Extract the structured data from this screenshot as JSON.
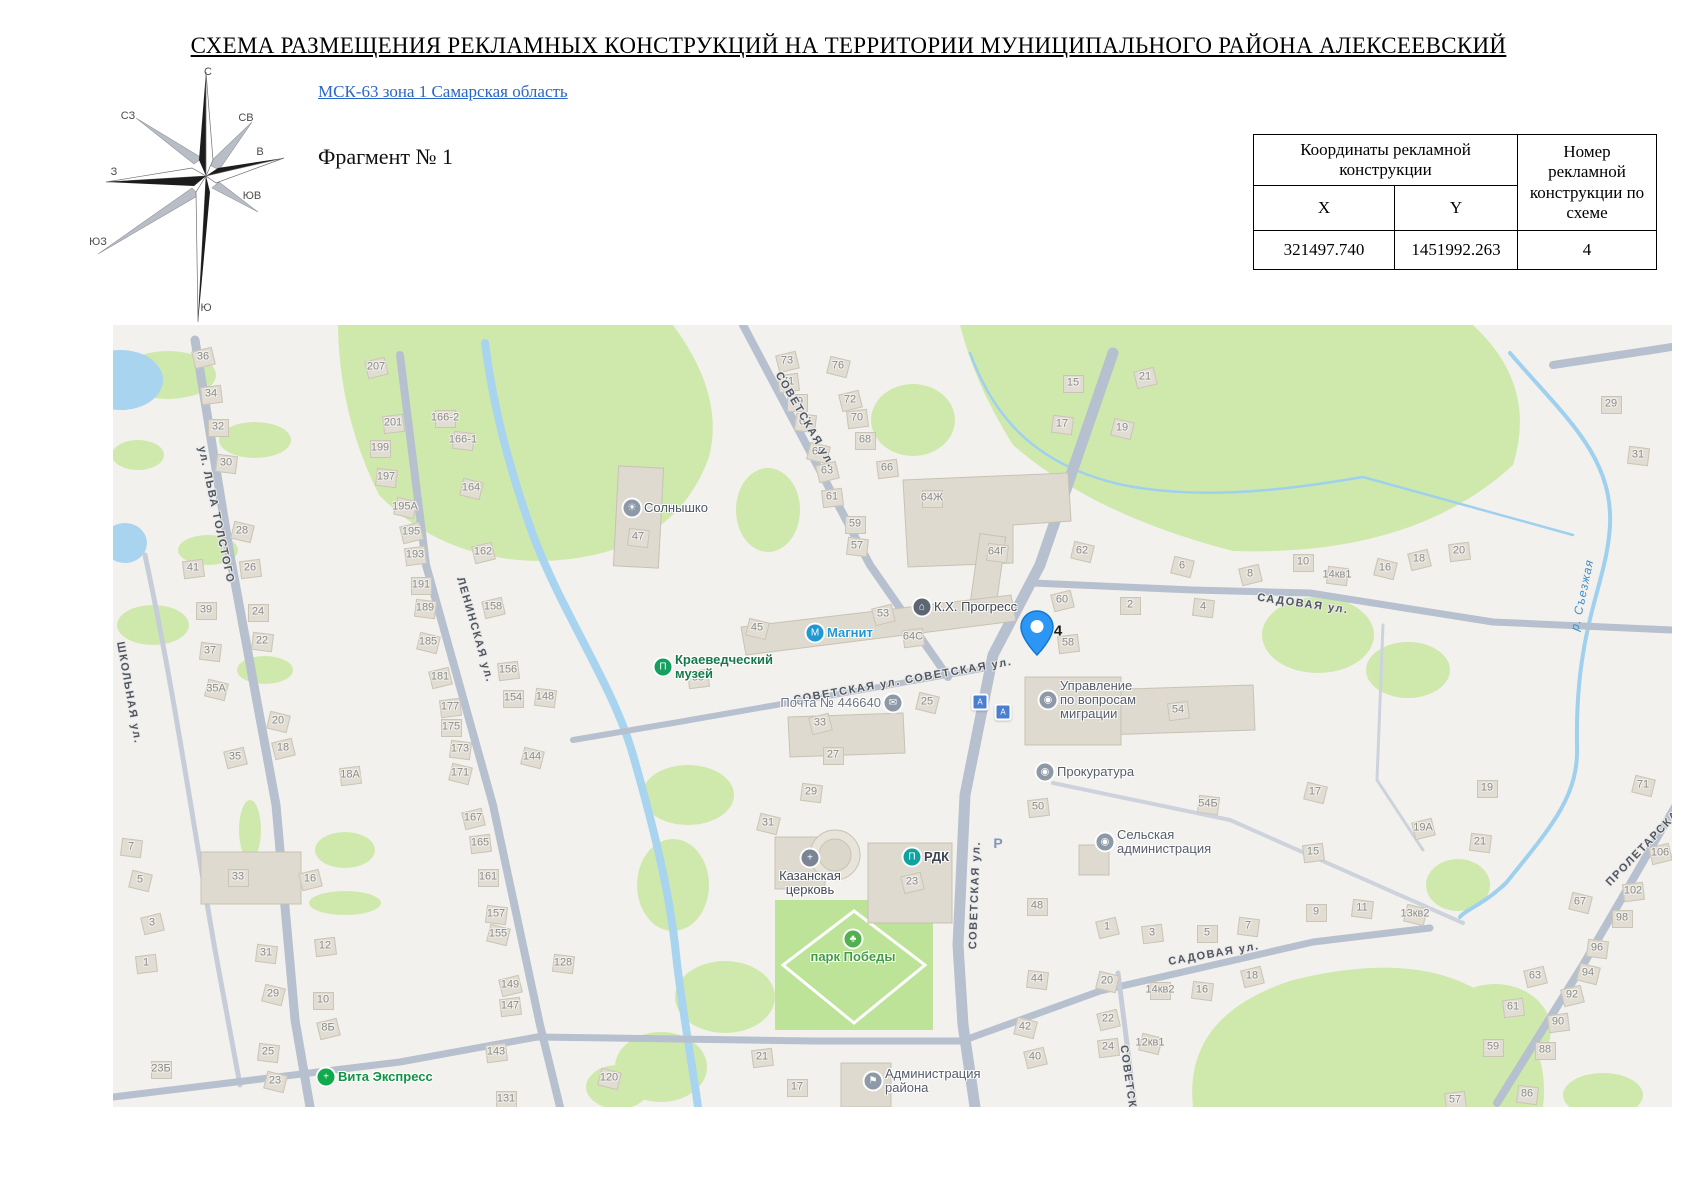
{
  "title": "СХЕМА РАЗМЕЩЕНИЯ РЕКЛАМНЫХ КОНСТРУКЦИЙ НА ТЕРРИТОРИИ МУНИЦИПАЛЬНОГО РАЙОНА АЛЕКСЕЕВСКИЙ",
  "header": {
    "link_label": "МСК-63 зона 1 Самарская область",
    "fragment_label": "Фрагмент № 1"
  },
  "compass": {
    "n": "С",
    "ne": "СВ",
    "e": "В",
    "se": "ЮВ",
    "s": "Ю",
    "sw": "ЮЗ",
    "w": "З",
    "nw": "СЗ"
  },
  "table": {
    "coords_header": "Координаты рекламной конструкции",
    "x_header": "X",
    "y_header": "Y",
    "number_header": "Номер рекламной конструкции по схеме",
    "x_value": "321497.740",
    "y_value": "1451992.263",
    "number_value": "4"
  },
  "map": {
    "colors": {
      "road": "#b6c0cf",
      "green": "#cfe9ad",
      "water": "#a8d4f0",
      "pin_blue": "#2b96f3",
      "building": "#dedacf"
    },
    "placemark": {
      "number": "4",
      "x": 924,
      "y": 330,
      "label_x": 945,
      "label_y": 306
    },
    "street_labels": [
      [
        "ул. ЛЬВА ТОЛСТОГО",
        103,
        190,
        78
      ],
      [
        "ШКОЛЬНАЯ ул.",
        16,
        368,
        80
      ],
      [
        "ЛЕНИНСКАЯ ул.",
        362,
        305,
        74
      ],
      [
        "СОВЕТСКАЯ ул.",
        692,
        95,
        60
      ],
      [
        "СОВЕТСКАЯ ул. СОВЕТСКАЯ ул.",
        790,
        356,
        -10
      ],
      [
        "СОВЕТСКАЯ ул.",
        862,
        570,
        -88
      ],
      [
        "СОВЕТСКАЯ ул.",
        1018,
        774,
        82
      ],
      [
        "САДОВАЯ ул.",
        1190,
        279,
        8
      ],
      [
        "САДОВАЯ ул.",
        1101,
        629,
        -10
      ],
      [
        "ПРОЛЕТАРСКАЯ",
        1533,
        520,
        -46
      ]
    ],
    "river_label": {
      "text": "р. Съезжая",
      "x": 1469,
      "y": 270,
      "rotate": -78
    },
    "pois": [
      {
        "text": "Солнышко",
        "x": 519,
        "y": 183,
        "icon": "sun-icon",
        "glyph": "☀",
        "icon_color": "#8e99a8",
        "label_color": "#4a5664",
        "pos": "right",
        "bold": false
      },
      {
        "text": "Магнит",
        "x": 702,
        "y": 308,
        "icon": "basket-icon",
        "glyph": "М",
        "icon_color": "#1f98d4",
        "label_color": "#1f98d4",
        "pos": "right",
        "bold": true
      },
      {
        "text": "Краеведческий\nмузей",
        "x": 550,
        "y": 342,
        "icon": "museum-icon",
        "glyph": "П",
        "icon_color": "#14a05e",
        "label_color": "#157a4a",
        "pos": "right",
        "bold": true
      },
      {
        "text": "К.Х. Прогресс",
        "x": 809,
        "y": 282,
        "icon": "factory-icon",
        "glyph": "⌂",
        "icon_color": "#5d6673",
        "label_color": "#3c4652",
        "pos": "right",
        "bold": false
      },
      {
        "text": "Почта № 446640",
        "x": 780,
        "y": 378,
        "icon": "envelope-icon",
        "glyph": "✉",
        "icon_color": "#8e99a8",
        "label_color": "#6d7684",
        "pos": "left",
        "bold": false
      },
      {
        "text": "Управление\nпо вопросам\nмиграции",
        "x": 935,
        "y": 375,
        "icon": "government-icon",
        "glyph": "◉",
        "icon_color": "#8e99a8",
        "label_color": "#555e6b",
        "pos": "right",
        "bold": false
      },
      {
        "text": "Прокуратура",
        "x": 932,
        "y": 447,
        "icon": "government-icon",
        "glyph": "◉",
        "icon_color": "#8e99a8",
        "label_color": "#555e6b",
        "pos": "right",
        "bold": false
      },
      {
        "text": "Сельская\nадминистрация",
        "x": 992,
        "y": 517,
        "icon": "government-icon",
        "glyph": "◉",
        "icon_color": "#8e99a8",
        "label_color": "#555e6b",
        "pos": "right",
        "bold": false
      },
      {
        "text": "РДК",
        "x": 799,
        "y": 532,
        "icon": "culture-icon",
        "glyph": "П",
        "icon_color": "#0fa3a0",
        "label_color": "#3a434f",
        "pos": "right",
        "bold": true
      },
      {
        "text": "парк Победы",
        "x": 740,
        "y": 614,
        "icon": "tree-icon",
        "glyph": "♣",
        "icon_color": "#52b050",
        "label_color": "#3f9e3f",
        "pos": "below",
        "bold": true
      },
      {
        "text": "Администрация\nрайона",
        "x": 760,
        "y": 756,
        "icon": "flag-icon",
        "glyph": "⚑",
        "icon_color": "#8e99a8",
        "label_color": "#555e6b",
        "pos": "right",
        "bold": false
      },
      {
        "text": "Казанская\nцерковь",
        "x": 697,
        "y": 533,
        "icon": "church-cross-icon",
        "glyph": "+",
        "icon_color": "#7b8494",
        "label_color": "#414b57",
        "pos": "below",
        "bold": false
      },
      {
        "text": "Вита Экспресс",
        "x": 213,
        "y": 752,
        "icon": "pharmacy-cross-icon",
        "glyph": "+",
        "icon_color": "#0faa4b",
        "label_color": "#0e9444",
        "pos": "right",
        "bold": true
      }
    ],
    "bus_stops": [
      [
        867,
        377
      ],
      [
        890,
        387
      ]
    ],
    "parking_label": {
      "text": "Р",
      "x": 885,
      "y": 518
    },
    "house_numbers": [
      [
        "36",
        90,
        32
      ],
      [
        "34",
        98,
        69
      ],
      [
        "32",
        105,
        102
      ],
      [
        "30",
        113,
        138
      ],
      [
        "28",
        129,
        206
      ],
      [
        "207",
        263,
        42
      ],
      [
        "201",
        280,
        98
      ],
      [
        "199",
        267,
        123
      ],
      [
        "197",
        273,
        152
      ],
      [
        "195А",
        292,
        182
      ],
      [
        "195",
        298,
        207
      ],
      [
        "193",
        302,
        230
      ],
      [
        "166-2",
        332,
        93
      ],
      [
        "166-1",
        350,
        115
      ],
      [
        "164",
        358,
        163
      ],
      [
        "162",
        370,
        227
      ],
      [
        "41",
        80,
        243
      ],
      [
        "39",
        93,
        285
      ],
      [
        "37",
        97,
        326
      ],
      [
        "35А",
        103,
        364
      ],
      [
        "35",
        122,
        432
      ],
      [
        "26",
        137,
        243
      ],
      [
        "24",
        145,
        287
      ],
      [
        "22",
        149,
        316
      ],
      [
        "20",
        165,
        396
      ],
      [
        "18",
        170,
        423
      ],
      [
        "18А",
        237,
        450
      ],
      [
        "191",
        308,
        260
      ],
      [
        "189",
        312,
        283
      ],
      [
        "185",
        315,
        317
      ],
      [
        "181",
        327,
        352
      ],
      [
        "177",
        337,
        382
      ],
      [
        "175",
        338,
        402
      ],
      [
        "173",
        347,
        424
      ],
      [
        "171",
        347,
        448
      ],
      [
        "158",
        380,
        282
      ],
      [
        "156",
        395,
        345
      ],
      [
        "154",
        400,
        373
      ],
      [
        "148",
        432,
        372
      ],
      [
        "144",
        419,
        432
      ],
      [
        "167",
        360,
        493
      ],
      [
        "165",
        367,
        518
      ],
      [
        "161",
        375,
        552
      ],
      [
        "157",
        383,
        589
      ],
      [
        "155",
        385,
        609
      ],
      [
        "149",
        397,
        660
      ],
      [
        "147",
        397,
        681
      ],
      [
        "33",
        125,
        552
      ],
      [
        "31",
        153,
        628
      ],
      [
        "29",
        160,
        669
      ],
      [
        "16",
        197,
        554
      ],
      [
        "12",
        212,
        621
      ],
      [
        "10",
        210,
        675
      ],
      [
        "7",
        18,
        522
      ],
      [
        "5",
        27,
        555
      ],
      [
        "3",
        39,
        598
      ],
      [
        "1",
        33,
        638
      ],
      [
        "23Б",
        48,
        744
      ],
      [
        "25",
        155,
        727
      ],
      [
        "23",
        162,
        756
      ],
      [
        "8Б",
        215,
        703
      ],
      [
        "143",
        383,
        727
      ],
      [
        "131",
        393,
        774
      ],
      [
        "128",
        450,
        638
      ],
      [
        "120",
        496,
        753
      ],
      [
        "73",
        674,
        36
      ],
      [
        "71",
        675,
        57
      ],
      [
        "69",
        684,
        77
      ],
      [
        "67",
        692,
        97
      ],
      [
        "65",
        705,
        127
      ],
      [
        "63",
        714,
        146
      ],
      [
        "61",
        719,
        172
      ],
      [
        "59",
        742,
        199
      ],
      [
        "57",
        744,
        221
      ],
      [
        "76",
        725,
        41
      ],
      [
        "72",
        737,
        75
      ],
      [
        "70",
        744,
        93
      ],
      [
        "68",
        752,
        115
      ],
      [
        "47",
        525,
        212
      ],
      [
        "45",
        644,
        303
      ],
      [
        "53",
        770,
        289
      ],
      [
        "64С",
        800,
        312
      ],
      [
        "15",
        960,
        58
      ],
      [
        "17",
        949,
        99
      ],
      [
        "19",
        1009,
        103
      ],
      [
        "21",
        1032,
        52
      ],
      [
        "66",
        774,
        143
      ],
      [
        "64Ж",
        819,
        173
      ],
      [
        "64Г",
        884,
        227
      ],
      [
        "62",
        969,
        226
      ],
      [
        "60",
        949,
        275
      ],
      [
        "58",
        955,
        318
      ],
      [
        "2",
        1017,
        280
      ],
      [
        "4",
        1090,
        282
      ],
      [
        "6",
        1069,
        241
      ],
      [
        "8",
        1137,
        249
      ],
      [
        "54",
        1065,
        385
      ],
      [
        "10",
        1190,
        237
      ],
      [
        "14кв1",
        1224,
        250
      ],
      [
        "16",
        1272,
        243
      ],
      [
        "18",
        1306,
        234
      ],
      [
        "20",
        1346,
        226
      ],
      [
        "29",
        1498,
        79
      ],
      [
        "31",
        1525,
        130
      ],
      [
        "25",
        814,
        377
      ],
      [
        "33",
        707,
        398
      ],
      [
        "35",
        585,
        353
      ],
      [
        "27",
        720,
        430
      ],
      [
        "29",
        698,
        467
      ],
      [
        "31",
        655,
        498
      ],
      [
        "23",
        799,
        557
      ],
      [
        "50",
        925,
        482
      ],
      [
        "48",
        924,
        581
      ],
      [
        "44",
        924,
        654
      ],
      [
        "42",
        912,
        702
      ],
      [
        "40",
        922,
        732
      ],
      [
        "21",
        649,
        732
      ],
      [
        "17",
        684,
        762
      ],
      [
        "54Б",
        1095,
        479
      ],
      [
        "17",
        1202,
        467
      ],
      [
        "19А",
        1310,
        503
      ],
      [
        "15",
        1200,
        527
      ],
      [
        "9",
        1203,
        587
      ],
      [
        "11",
        1249,
        583
      ],
      [
        "13кв2",
        1302,
        589
      ],
      [
        "1",
        994,
        602
      ],
      [
        "3",
        1039,
        608
      ],
      [
        "5",
        1094,
        608
      ],
      [
        "7",
        1135,
        601
      ],
      [
        "20",
        994,
        656
      ],
      [
        "22",
        995,
        694
      ],
      [
        "24",
        995,
        722
      ],
      [
        "14кв2",
        1047,
        665
      ],
      [
        "16",
        1089,
        665
      ],
      [
        "12кв1",
        1037,
        718
      ],
      [
        "18",
        1139,
        651
      ],
      [
        "57",
        1342,
        775
      ],
      [
        "19",
        1374,
        463
      ],
      [
        "21",
        1367,
        517
      ],
      [
        "71",
        1530,
        460
      ],
      [
        "106",
        1547,
        528
      ],
      [
        "102",
        1520,
        566
      ],
      [
        "98",
        1509,
        593
      ],
      [
        "96",
        1484,
        623
      ],
      [
        "94",
        1475,
        648
      ],
      [
        "92",
        1459,
        670
      ],
      [
        "90",
        1445,
        697
      ],
      [
        "88",
        1432,
        725
      ],
      [
        "86",
        1414,
        769
      ],
      [
        "67",
        1467,
        577
      ],
      [
        "63",
        1422,
        651
      ],
      [
        "61",
        1400,
        682
      ],
      [
        "59",
        1380,
        722
      ]
    ]
  }
}
